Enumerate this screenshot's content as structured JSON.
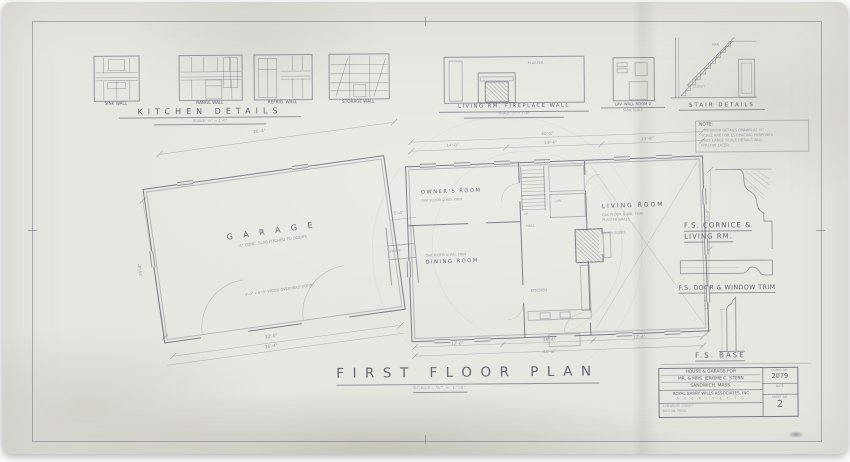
{
  "palette": {
    "paper": "#e8e6e1",
    "pencil_ink": "#5e6070"
  },
  "kitchen_details": {
    "panels": [
      {
        "label": "SINK WALL"
      },
      {
        "label": "RANGE WALL"
      },
      {
        "label": "REFRIG. WALL"
      },
      {
        "label": "STORAGE WALL"
      }
    ],
    "title": "KITCHEN DETAILS",
    "scale": "SCALE: ½\" = 1'-0\""
  },
  "fireplace_wall": {
    "label": "LIVING RM. FIREPLACE WALL",
    "scale": "SCALE: ½\" = 1'-0\"",
    "wall_note": "PLASTER"
  },
  "lav_wall": {
    "label": "LAV. WALL ROOM 2",
    "scale": "SAME SCALE"
  },
  "stair_details": {
    "title": "STAIR DETAILS",
    "rail_note": "RAIL",
    "under_note": "CLOSET"
  },
  "note": {
    "heading": "NOTE:",
    "line1": "INTERIOR DETAILS DRAWN AT ½\"",
    "line2": "SCALE ARE FOR ESTIMATING PURPOSES",
    "line3": "ONLY. LARGE SCALE DETAILS WILL",
    "line4": "FOLLOW LATER."
  },
  "profiles": {
    "cornice_line1": "F.S. CORNICE &",
    "cornice_line2": "LIVING RM.",
    "trim_label": "F.S. DOOR & WINDOW TRIM",
    "base_label": "F.S. BASE"
  },
  "plan": {
    "garage": {
      "name": "G A R A G E",
      "floor_note": "4\" CONC. SLAB PITCHED TO DOORS",
      "door_note": "9'-0\" x 6'-8\" WOOD OVERHEAD DOORS"
    },
    "stoop_label": "STOOP",
    "owners_room": {
      "name": "OWNER'S ROOM",
      "note": "OAK FLOOR & WD. TRIM"
    },
    "living_room": {
      "name": "LIVING ROOM",
      "note1": "OAK FLOOR & WD. TRIM",
      "note2": "PLASTER WALLS",
      "note3": "FLUSH DOORS"
    },
    "dining_room": {
      "name": "DINING ROOM",
      "note": "OAK FLOOR & WD. TRIM"
    },
    "kitchen_label": "KITCHEN",
    "hall_label": "HALL",
    "lav_label": "LAV.",
    "up_label": "UP",
    "dims": [
      "26'-4\"",
      "24'-4\"",
      "22'-0\"",
      "26'-4\"",
      "40'-8\"",
      "14'-0\"",
      "13'-4\"",
      "12'-8\"",
      "13'-0\"",
      "15'-6\"",
      "12'-0\"",
      "16'-4\"",
      "12'-4\"",
      "40'-8\"",
      "5'-4\""
    ]
  },
  "caption": {
    "title": "FIRST FLOOR PLAN",
    "scale": "SCALE: ¼\" = 1'-0\""
  },
  "title_block": {
    "project_line1": "HOUSE & GARAGE FOR",
    "project_line2": "MR. & MRS. JEROME C. STERN",
    "project_line3": "SANDWICH, MASS.",
    "firm": "ROYAL BARRY WILLS ASSOCIATES, INC",
    "firm_sub": "A R C H I T E C T S",
    "addr_line1": "8 NEWBURY STREET",
    "addr_line2": "BOSTON, MASS.",
    "comm_label": "COMM. NO.",
    "comm_no": "2079",
    "date_label": "DATE",
    "sheet_label": "SHEET NO.",
    "sheet_no": "2"
  }
}
